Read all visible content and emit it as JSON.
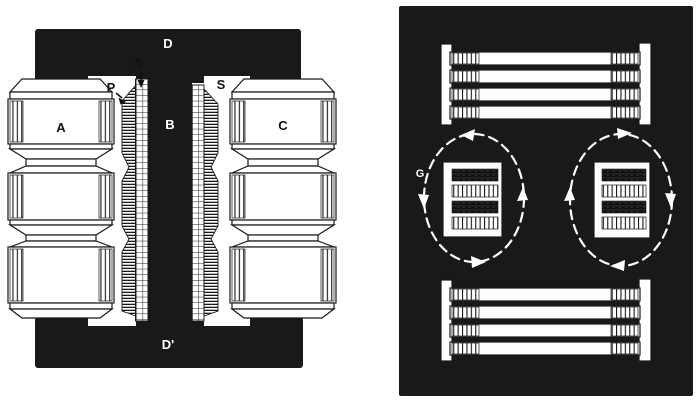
{
  "illustration": {
    "ink_color": "#191919",
    "paper_color": "#ffffff",
    "left_figure": {
      "kind": "shell-type transformer cross-section",
      "labels": {
        "top_yoke": "D",
        "center_leg": "B",
        "bottom_yoke": "D'",
        "left_coil": "A",
        "right_coil": "C",
        "secondary_top": "S",
        "primary": "P",
        "secondary_right": "S"
      }
    },
    "right_figure": {
      "kind": "interleaved windings with leakage-flux loops",
      "labels": {
        "leakage_gap": "G"
      },
      "flux_loops": [
        {
          "side": "left",
          "direction": "counterclockwise"
        },
        {
          "side": "right",
          "direction": "clockwise"
        }
      ]
    }
  }
}
